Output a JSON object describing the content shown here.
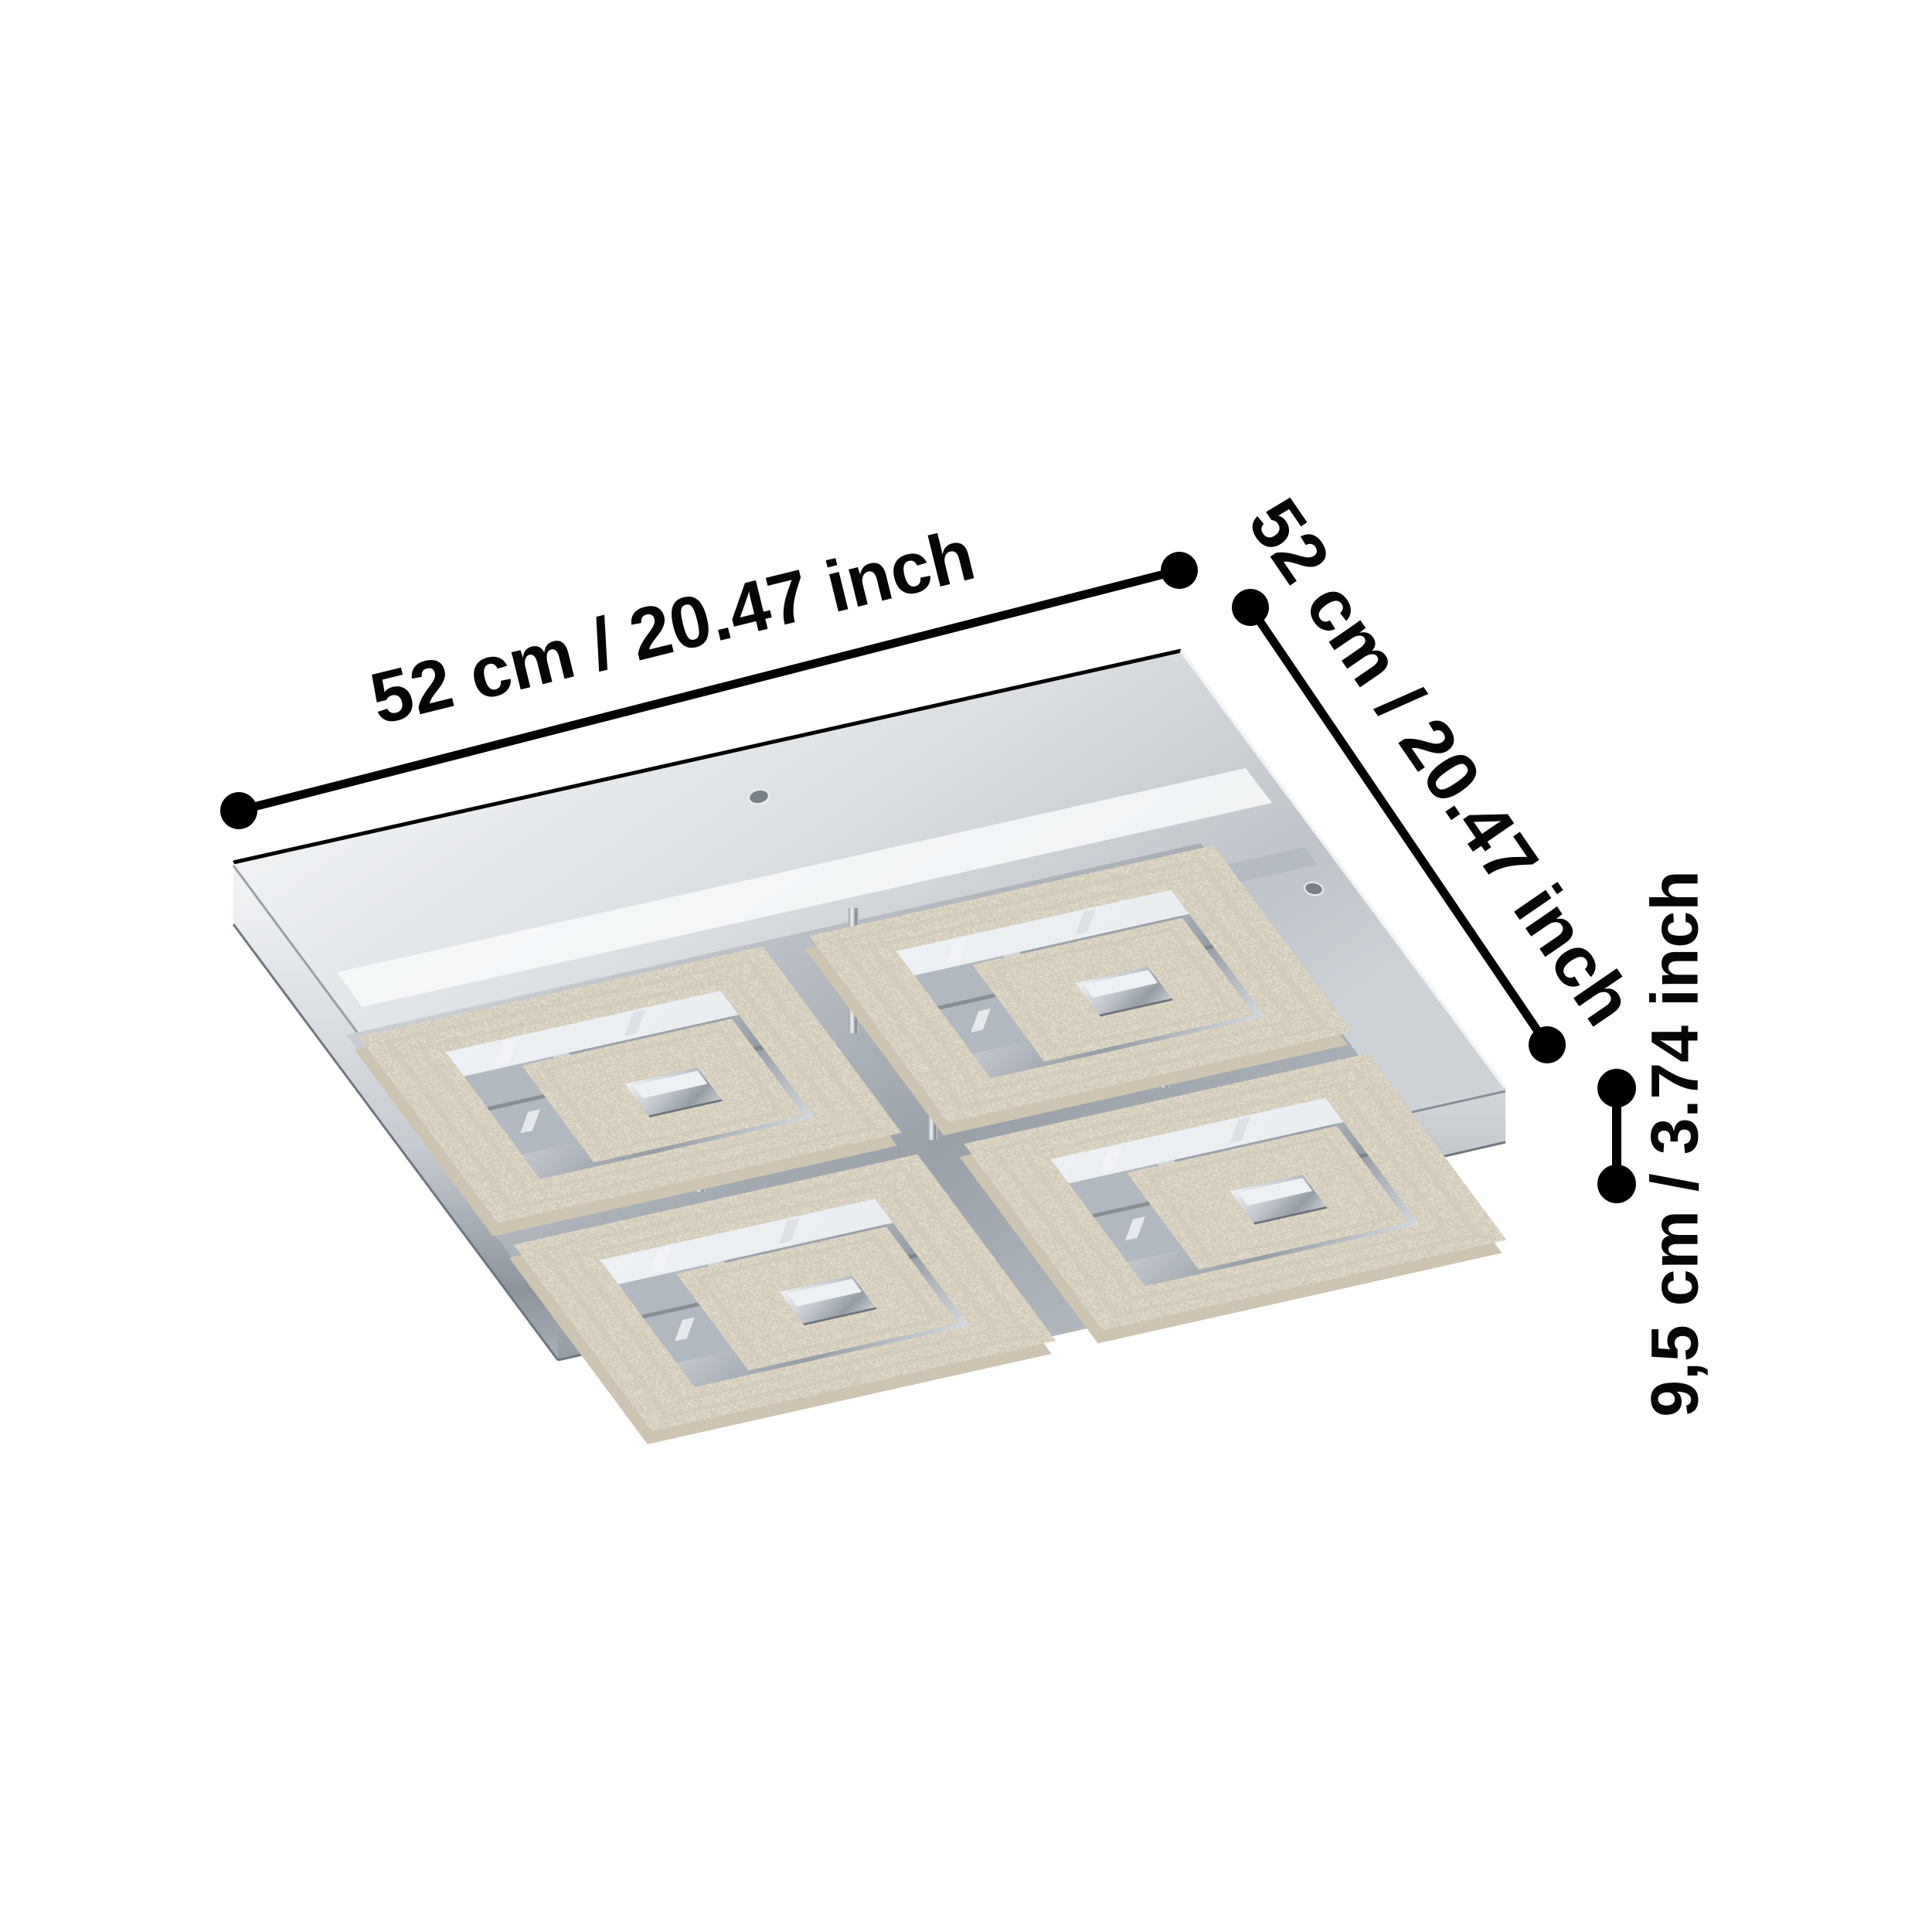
{
  "diagram": {
    "type": "product-dimension-diagram",
    "subject": "square crystal LED ceiling light, chrome plate with four square crystal rings"
  },
  "dimensions": {
    "width": {
      "label": "52 cm / 20.47 inch"
    },
    "depth": {
      "label": "52 cm / 20.47 inch"
    },
    "height": {
      "label": "9,5 cm / 3.74 inch"
    }
  },
  "palette": {
    "dimension_ink": "#000000",
    "background": "#ffffff",
    "chrome_light": "#eef1f4",
    "chrome_mid": "#b9bfc5",
    "chrome_dark": "#868d95",
    "crystal_face": "#e9e2d3",
    "crystal_side": "#cdc5b1"
  }
}
